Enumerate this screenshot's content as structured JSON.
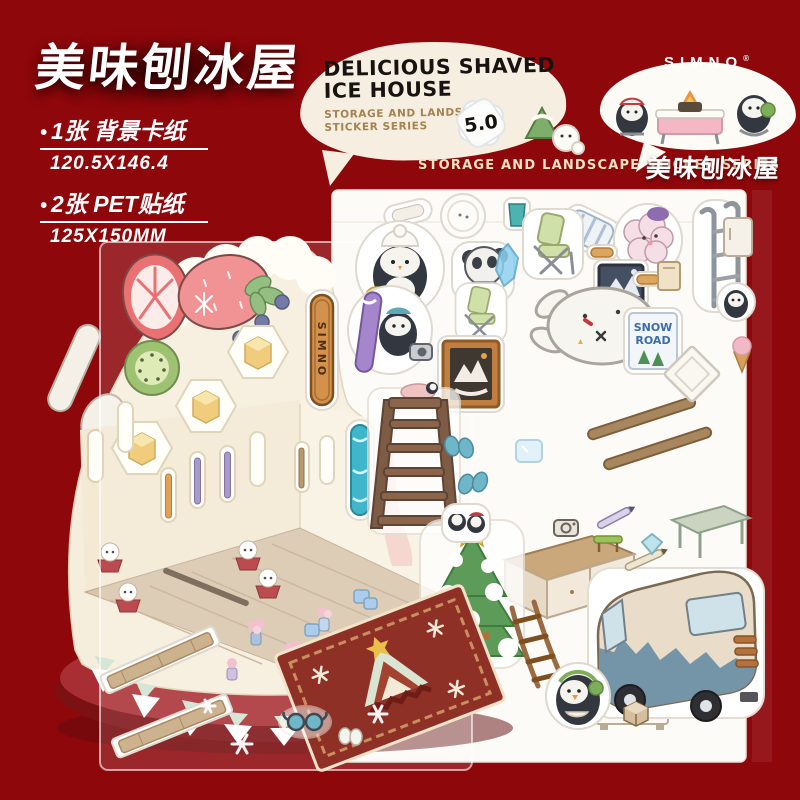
{
  "header": {
    "title": "美味刨冰屋",
    "bullet": "•",
    "specs": [
      {
        "label": "1张 背景卡纸",
        "size": "120.5X146.4"
      },
      {
        "label": "2张 PET贴纸",
        "size": "125X150MM"
      }
    ]
  },
  "bubble": {
    "title_line1": "DELICIOUS SHAVED",
    "title_line2": "ICE HOUSE",
    "subtitle_line1": "STORAGE AND LANDSCAPE",
    "subtitle_line2": "STICKER SERIES",
    "badge": "5.0"
  },
  "brand": {
    "name": "SIMNO",
    "reg": "®",
    "title_cn": "美味刨冰屋"
  },
  "series_banner": "STORAGE AND LANDSCAPE STICKER SERIES",
  "stickers": {
    "wood_sign": "SIMNO",
    "snow_line1": "SNOW",
    "snow_line2": "ROAD"
  },
  "colors": {
    "background": "#8e070b",
    "bubble_cream": "#f6efe1",
    "bubble_white": "#fdfbf5",
    "subtitle_tan": "#a5834e",
    "banner_cream": "#f0e2c4",
    "card_cream": "#f6eedd",
    "sheet_white": "#fcfbf7",
    "plate_red": "#a82e33",
    "plate_dark": "#7c1114",
    "rug_red": "#8f3026",
    "mint": "#cfe3cf",
    "sign_blue": "#3a6ca8",
    "wood": "#d3924c"
  }
}
